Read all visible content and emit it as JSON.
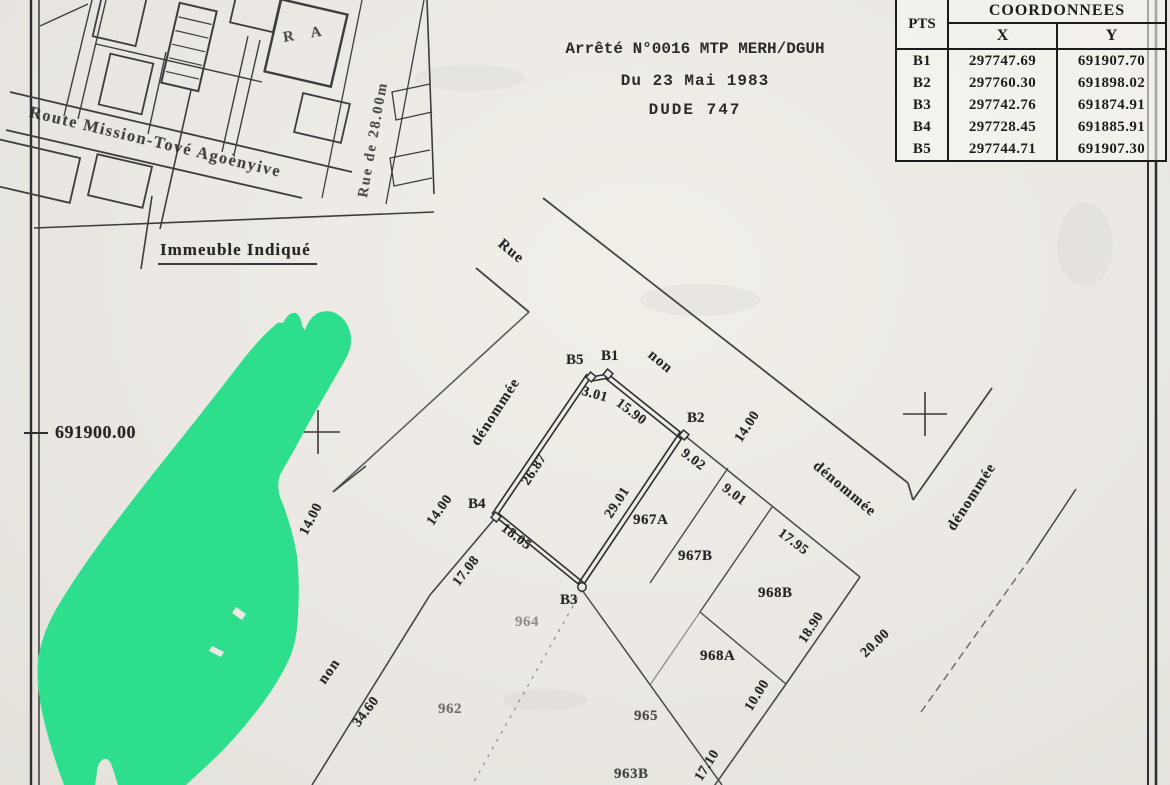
{
  "arrete": {
    "line1": "Arrêté N°0016 MTP MERH/DGUH",
    "line2": "Du 23 Mai 1983",
    "line3": "DUDE 747"
  },
  "coordinates_table": {
    "title": "COORDONNEES",
    "col_pts": "PTS",
    "col_x": "X",
    "col_y": "Y",
    "rows": [
      {
        "pt": "B1",
        "x": "297747.69",
        "y": "691907.70"
      },
      {
        "pt": "B2",
        "x": "297760.30",
        "y": "691898.02"
      },
      {
        "pt": "B3",
        "x": "297742.76",
        "y": "691874.91"
      },
      {
        "pt": "B4",
        "x": "297728.45",
        "y": "691885.91"
      },
      {
        "pt": "B5",
        "x": "297744.71",
        "y": "691907.30"
      }
    ]
  },
  "inset_map": {
    "road_label": "Route Mission-Tové Agoènyive",
    "street_label": "Rue de 28.00m",
    "block_label": "R A",
    "callout_label": "Immeuble Indiqué"
  },
  "plan": {
    "grid_label": "691900.00",
    "streets": {
      "rue": "Rue",
      "non_ne": "non",
      "denommee_ne": "dénommée",
      "denommee_nw": "dénommée",
      "denommee_se": "dénommée",
      "non_sw": "non"
    },
    "points": {
      "b1": "B1",
      "b2": "B2",
      "b3": "B3",
      "b4": "B4",
      "b5": "B5"
    },
    "parcels": {
      "p967a": "967A",
      "p967b": "967B",
      "p968b": "968B",
      "p968a": "968A",
      "p964": "964",
      "p965": "965",
      "p962": "962",
      "p963b": "963B"
    },
    "dimensions": {
      "b5_b1": "3.01",
      "b1_b2": "15.90",
      "b2_b3": "29.01",
      "b3_b4": "18.05",
      "b4_b5": "26.87",
      "front_967a": "9.02",
      "front_967b": "9.01",
      "front_968b": "17.95",
      "side_968b": "18.90",
      "front_968a": "10.00",
      "front_965": "17.10",
      "width_street_ne": "14.00",
      "width_street_nw": "14.00",
      "width_street_sw": "14.00",
      "width_street_se": "20.00",
      "side_964": "17.08",
      "len_street_sw": "34.60"
    }
  },
  "colors": {
    "highlight_green": "#2dde8c",
    "paper": "#ebe8e3",
    "ink": "#262626"
  }
}
